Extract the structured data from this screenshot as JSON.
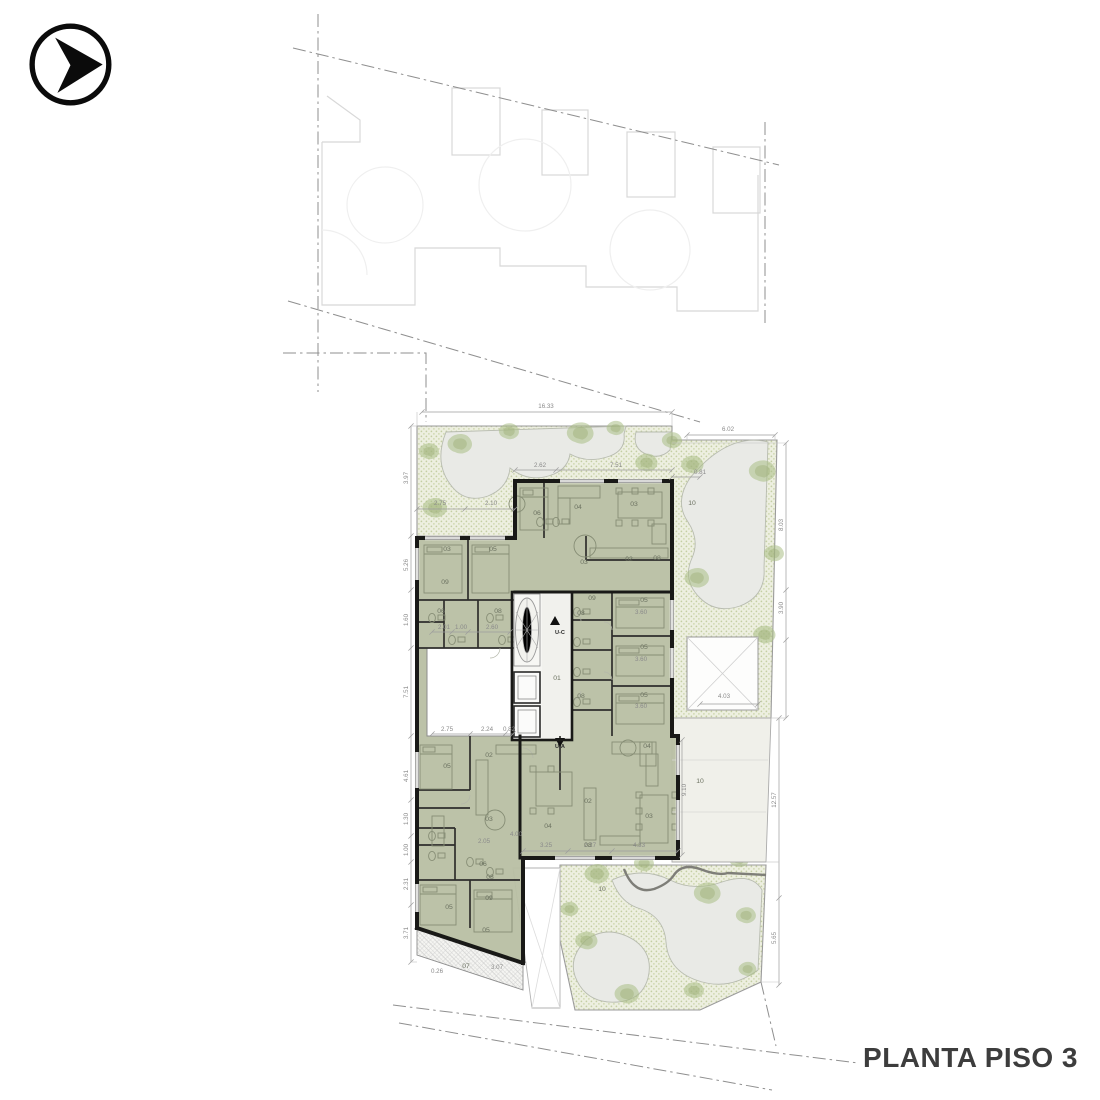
{
  "title_block": {
    "floor_label": "PLANTA PISO 3"
  },
  "nav_icon": {
    "name": "arrow-right-circle"
  },
  "plan": {
    "room_labels": [
      {
        "n": "06",
        "x": 537,
        "y": 515
      },
      {
        "n": "04",
        "x": 578,
        "y": 509
      },
      {
        "n": "03",
        "x": 634,
        "y": 506
      },
      {
        "n": "02",
        "x": 629,
        "y": 561
      },
      {
        "n": "08",
        "x": 657,
        "y": 560
      },
      {
        "n": "03",
        "x": 584,
        "y": 564
      },
      {
        "n": "09",
        "x": 592,
        "y": 600
      },
      {
        "n": "05",
        "x": 644,
        "y": 602
      },
      {
        "n": "05",
        "x": 644,
        "y": 649
      },
      {
        "n": "05",
        "x": 644,
        "y": 697
      },
      {
        "n": "08",
        "x": 581,
        "y": 615
      },
      {
        "n": "08",
        "x": 581,
        "y": 698
      },
      {
        "n": "03",
        "x": 447,
        "y": 551
      },
      {
        "n": "05",
        "x": 493,
        "y": 551
      },
      {
        "n": "09",
        "x": 445,
        "y": 584
      },
      {
        "n": "06",
        "x": 441,
        "y": 613
      },
      {
        "n": "08",
        "x": 498,
        "y": 613
      },
      {
        "n": "01",
        "x": 557,
        "y": 680
      },
      {
        "n": "05",
        "x": 447,
        "y": 768
      },
      {
        "n": "02",
        "x": 489,
        "y": 757
      },
      {
        "n": "03",
        "x": 489,
        "y": 821
      },
      {
        "n": "04",
        "x": 548,
        "y": 828
      },
      {
        "n": "06",
        "x": 483,
        "y": 866
      },
      {
        "n": "08",
        "x": 490,
        "y": 879
      },
      {
        "n": "09",
        "x": 489,
        "y": 900
      },
      {
        "n": "05",
        "x": 449,
        "y": 909
      },
      {
        "n": "05",
        "x": 486,
        "y": 932
      },
      {
        "n": "07",
        "x": 466,
        "y": 968
      },
      {
        "n": "04",
        "x": 647,
        "y": 748
      },
      {
        "n": "03",
        "x": 649,
        "y": 818
      },
      {
        "n": "02",
        "x": 588,
        "y": 803
      },
      {
        "n": "08",
        "x": 588,
        "y": 847
      },
      {
        "n": "10",
        "x": 692,
        "y": 505
      },
      {
        "n": "10",
        "x": 700,
        "y": 783
      },
      {
        "n": "10",
        "x": 602,
        "y": 891
      }
    ],
    "dimensions": [
      {
        "t": "16.33",
        "x": 546,
        "y": 408,
        "r": 0
      },
      {
        "t": "6.02",
        "x": 728,
        "y": 431,
        "r": 0
      },
      {
        "t": "2.62",
        "x": 540,
        "y": 467,
        "r": 0
      },
      {
        "t": "7.51",
        "x": 616,
        "y": 467,
        "r": 0
      },
      {
        "t": "0.81",
        "x": 700,
        "y": 474,
        "r": 0
      },
      {
        "t": "2.75",
        "x": 440,
        "y": 505,
        "r": 0
      },
      {
        "t": "2.10",
        "x": 491,
        "y": 505,
        "r": 0
      },
      {
        "t": "3.97",
        "x": 408,
        "y": 478,
        "r": -90
      },
      {
        "t": "5.26",
        "x": 408,
        "y": 565,
        "r": -90
      },
      {
        "t": "1.60",
        "x": 408,
        "y": 620,
        "r": -90
      },
      {
        "t": "7.51",
        "x": 408,
        "y": 692,
        "r": -90
      },
      {
        "t": "4.61",
        "x": 408,
        "y": 776,
        "r": -90
      },
      {
        "t": "1.30",
        "x": 408,
        "y": 819,
        "r": -90
      },
      {
        "t": "1.00",
        "x": 408,
        "y": 850,
        "r": -90
      },
      {
        "t": "2.31",
        "x": 408,
        "y": 884,
        "r": -90
      },
      {
        "t": "3.71",
        "x": 408,
        "y": 933,
        "r": -90
      },
      {
        "t": "2.01",
        "x": 444,
        "y": 629,
        "r": 0
      },
      {
        "t": "1.00",
        "x": 461,
        "y": 629,
        "r": 0
      },
      {
        "t": "2.60",
        "x": 492,
        "y": 629,
        "r": 0
      },
      {
        "t": "2.75",
        "x": 447,
        "y": 731,
        "r": 0
      },
      {
        "t": "2.24",
        "x": 487,
        "y": 731,
        "r": 0
      },
      {
        "t": "0.82",
        "x": 509,
        "y": 731,
        "r": 0
      },
      {
        "t": "3.25",
        "x": 546,
        "y": 847,
        "r": 0
      },
      {
        "t": "2.27",
        "x": 590,
        "y": 847,
        "r": 0
      },
      {
        "t": "4.33",
        "x": 639,
        "y": 847,
        "r": 0
      },
      {
        "t": "0.26",
        "x": 437,
        "y": 973,
        "r": 0
      },
      {
        "t": "3.07",
        "x": 497,
        "y": 969,
        "r": 0
      },
      {
        "t": "8.03",
        "x": 783,
        "y": 525,
        "r": -90
      },
      {
        "t": "3.90",
        "x": 783,
        "y": 608,
        "r": -90
      },
      {
        "t": "4.03",
        "x": 724,
        "y": 698,
        "r": 0
      },
      {
        "t": "12.57",
        "x": 776,
        "y": 800,
        "r": -90
      },
      {
        "t": "5.65",
        "x": 776,
        "y": 938,
        "r": -90
      },
      {
        "t": "9.10",
        "x": 686,
        "y": 790,
        "r": -90
      },
      {
        "t": "3.60",
        "x": 641,
        "y": 614,
        "r": 0
      },
      {
        "t": "3.60",
        "x": 641,
        "y": 661,
        "r": 0
      },
      {
        "t": "3.60",
        "x": 641,
        "y": 708,
        "r": 0
      },
      {
        "t": "2.05",
        "x": 484,
        "y": 843,
        "r": 0
      },
      {
        "t": "4.00",
        "x": 516,
        "y": 836,
        "r": 0
      }
    ],
    "unit_markers": [
      {
        "t": "U-C",
        "x": 560,
        "y": 634
      },
      {
        "t": "U-A",
        "x": 560,
        "y": 748
      }
    ]
  }
}
